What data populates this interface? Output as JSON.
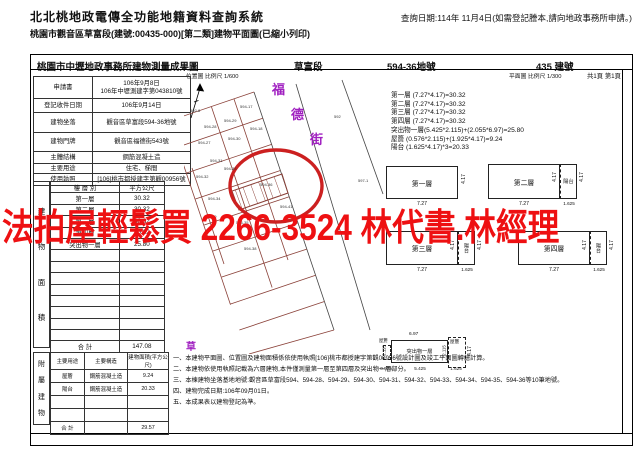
{
  "header": {
    "system_title": "北北桃地政電傳全功能地籍資料查詢系統",
    "document_title": "桃園市觀音區草富段(建號:00435-000)[第二類]建物平面圖(已縮小列印)",
    "query_date": "查詢日期:114年 11月4日(如需登記謄本,請向地政事務所申請。)"
  },
  "watermark": {
    "text": "法拍屋輕鬆買 2266-3524 林代書.林經理",
    "color": "#ee1012"
  },
  "sheet": {
    "title": "桃園市中壢地政事務所建物測量成果圖",
    "section_name": "草富段",
    "land_number": "594-36地號",
    "building_number": "435 建號",
    "location_map_scale": "位置圖 比例尺 1/600",
    "floor_plan_scale": "平面圖 比例尺 1/300",
    "page_info": "共1頁 第1頁"
  },
  "info_table": {
    "rows": [
      {
        "label": "申請書",
        "value": "106年9月8日\n106年中壢測建字第043810號"
      },
      {
        "label": "登記收件日期",
        "value": "106年9月14日"
      },
      {
        "label": "建物坐落",
        "value": "觀音區草富段594-36地號"
      },
      {
        "label": "建物門牌",
        "value": "觀音區福德街543號"
      },
      {
        "label": "主體結構",
        "value": "鋼筋混凝土造"
      },
      {
        "label": "主要用途",
        "value": "住宅、梯間"
      },
      {
        "label": "使用執照",
        "value": "[106]桃市都授建字第觀00956號"
      }
    ]
  },
  "floor_area_table": {
    "side_label": "建物面積",
    "col_floor": "樓 層 別",
    "col_area": "平方公尺",
    "rows": [
      {
        "floor": "第一層",
        "area": "30.32"
      },
      {
        "floor": "第二層",
        "area": "30.32"
      },
      {
        "floor": "第三層",
        "area": "30.32"
      },
      {
        "floor": "第四層",
        "area": "30.32"
      },
      {
        "floor": "突出物一層",
        "area": "25.80"
      }
    ],
    "total_label": "合 計",
    "total_value": "147.08"
  },
  "annex_table": {
    "side_label": "附屬建物",
    "headers": [
      "主要用途",
      "主要構造",
      "建物面積(平方公尺)"
    ],
    "rows": [
      {
        "use": "屋簷",
        "structure": "鋼筋混凝土造",
        "area": "9.24"
      },
      {
        "use": "陽台",
        "structure": "鋼筋混凝土造",
        "area": "20.33"
      }
    ],
    "total_label": "合 計",
    "total_value": "29.57"
  },
  "measurements": [
    "第一層 (7.27*4.17)=30.32",
    "第二層 (7.27*4.17)=30.32",
    "第三層 (7.27*4.17)=30.32",
    "第四層 (7.27*4.17)=30.32",
    "突出物一層(5.425*2.115)+(2.055*6.97)=25.80",
    "屋簷 (0.576*2.115)+(1.925*4.17)=9.24",
    "陽台 (1.625*4.17)*3=20.33"
  ],
  "floor_plans": {
    "p1": {
      "name": "第一層",
      "w": "7.27",
      "h": "4.17"
    },
    "p2": {
      "name": "第二層",
      "bl": "陽台",
      "w": "7.27",
      "bw": "1.625",
      "h": "4.17",
      "bh": "4.17"
    },
    "p3": {
      "name": "第三層",
      "bl": "陽台",
      "w": "7.27",
      "bw": "1.625",
      "h": "4.17",
      "bh": "4.17"
    },
    "p4": {
      "name": "第四層",
      "bl": "陽台",
      "w": "7.27",
      "bw": "1.625",
      "h": "4.17",
      "bh": "4.17"
    },
    "prot": {
      "name": "突出物一層",
      "top_dim": "6.97",
      "eave_right": "屋簷",
      "eave_left": "屋簷",
      "d1": "0.575",
      "d2": "5.425",
      "d3": "1.625",
      "v1": "2.115",
      "v2": "2.115",
      "v3": "4.17"
    }
  },
  "map": {
    "street_name": "福德街",
    "corner_label": "草",
    "subject_parcel": "594-36",
    "street_label_color": "#a020c0",
    "highlight_circle_color": "#cc2020",
    "parcel_line_color": "#8a4038",
    "parcels": [
      {
        "id": "592-8",
        "x": 6,
        "y": 34
      },
      {
        "id": "594-17",
        "x": 56,
        "y": 30
      },
      {
        "id": "594-28",
        "x": 20,
        "y": 50
      },
      {
        "id": "594-29",
        "x": 40,
        "y": 44
      },
      {
        "id": "594-18",
        "x": 66,
        "y": 52
      },
      {
        "id": "594-27",
        "x": 14,
        "y": 66
      },
      {
        "id": "594-30",
        "x": 44,
        "y": 62
      },
      {
        "id": "594-31",
        "x": 26,
        "y": 84
      },
      {
        "id": "594-32",
        "x": 12,
        "y": 100
      },
      {
        "id": "594-33",
        "x": 40,
        "y": 92
      },
      {
        "id": "594-34",
        "x": 24,
        "y": 122
      },
      {
        "id": "594-39",
        "x": 20,
        "y": 140
      },
      {
        "id": "594-35",
        "x": 52,
        "y": 146
      },
      {
        "id": "594-36",
        "x": 76,
        "y": 108
      },
      {
        "id": "594-41",
        "x": 96,
        "y": 130
      },
      {
        "id": "594-37",
        "x": 36,
        "y": 160
      },
      {
        "id": "594-38",
        "x": 60,
        "y": 172
      },
      {
        "id": "592",
        "x": 150,
        "y": 40
      },
      {
        "id": "597-1",
        "x": 174,
        "y": 104
      }
    ]
  },
  "notes": [
    "一、本建物平面圖、位置圖及建物面積係依使用執照[106]桃市都授建字第觀00956號設計圖及竣工平面圖轉繪計算。",
    "二、本建物依使用執照記載為六層建物,本件僅測量第一層至第四層及突出物一層部分。",
    "三、本棟建物坐落基地地號:觀音區草富段594、594-28、594-29、594-30、594-31、594-32、594-33、594-34、594-35、594-36等10筆地號。",
    "四、建物完成日期:106年09月01日。",
    "五、本成果表以建物登記為準。"
  ]
}
